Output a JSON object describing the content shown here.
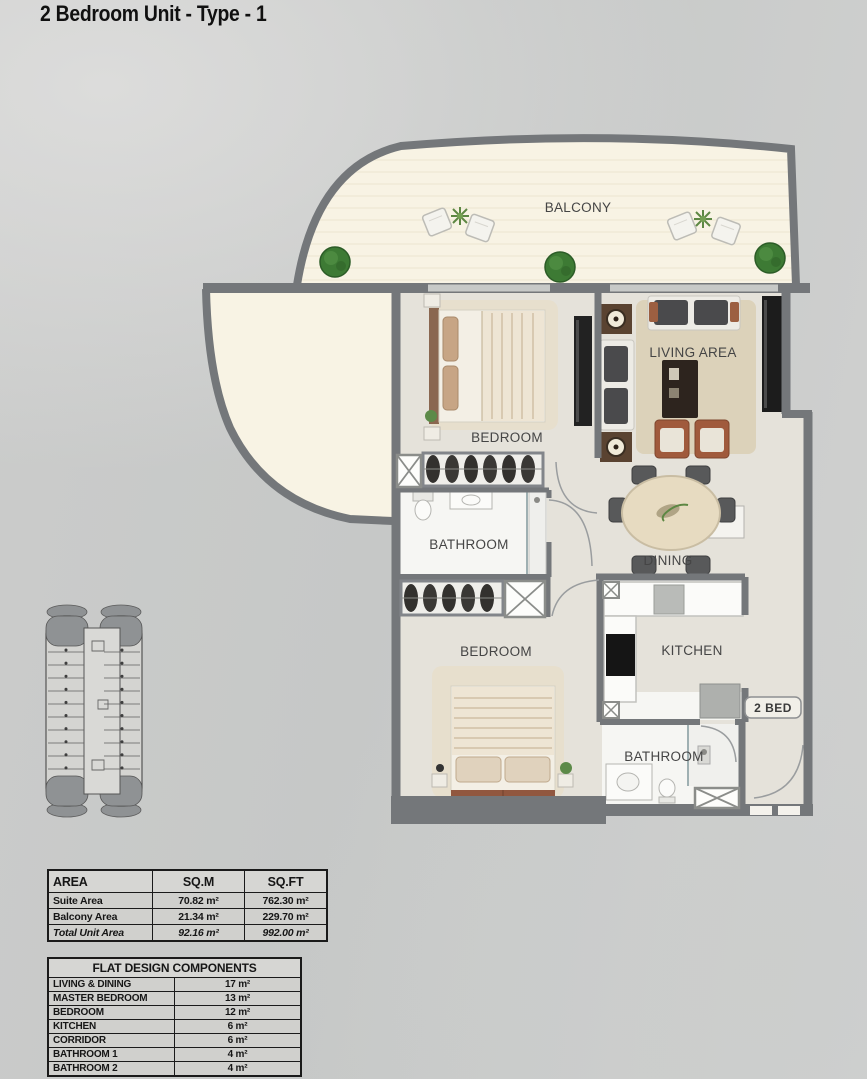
{
  "title": "2 Bedroom Unit - Type - 1",
  "plan": {
    "labels": {
      "balcony": "BALCONY",
      "master_bedroom": "BEDROOM",
      "living_area": "LIVING AREA",
      "bathroom1": "BATHROOM",
      "dining": "DINING",
      "bedroom2": "BEDROOM",
      "kitchen": "KITCHEN",
      "bathroom2": "BATHROOM",
      "unit_tag": "2 BED"
    },
    "colors": {
      "wall": "#74777a",
      "balcony_floor": "#f8f3e4",
      "room_floor": "#e5e2da",
      "wet_floor": "#f6f6f3",
      "rug": "#dcd2ba",
      "plant": "#3d7a34",
      "furniture_dark": "#1c1c1c",
      "furniture_brown": "#a05a3c"
    }
  },
  "area_table": {
    "headers": [
      "AREA",
      "SQ.M",
      "SQ.FT"
    ],
    "rows": [
      {
        "label": "Suite Area",
        "sqm": "70.82 m²",
        "sqft": "762.30 m²"
      },
      {
        "label": "Balcony Area",
        "sqm": "21.34 m²",
        "sqft": "229.70 m²"
      },
      {
        "label": "Total Unit Area",
        "sqm": "92.16 m²",
        "sqft": "992.00 m²"
      }
    ]
  },
  "components_table": {
    "title": "FLAT DESIGN COMPONENTS",
    "rows": [
      {
        "label": "LIVING & DINING",
        "value": "17 m²"
      },
      {
        "label": "MASTER BEDROOM",
        "value": "13 m²"
      },
      {
        "label": "BEDROOM",
        "value": "12 m²"
      },
      {
        "label": "KITCHEN",
        "value": "6 m²"
      },
      {
        "label": "CORRIDOR",
        "value": "6 m²"
      },
      {
        "label": "BATHROOM 1",
        "value": "4 m²"
      },
      {
        "label": "BATHROOM 2",
        "value": "4 m²"
      }
    ]
  }
}
